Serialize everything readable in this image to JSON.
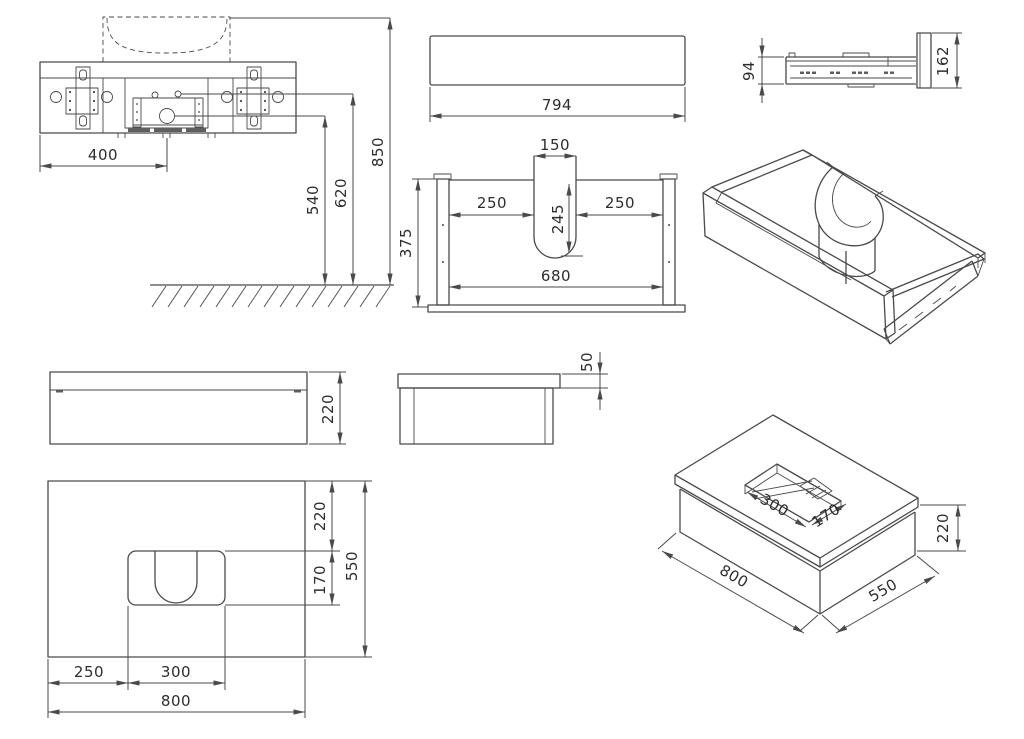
{
  "drawing": {
    "background": "#ffffff",
    "line_color": "#4a4a4a",
    "text_color": "#2d2d2d",
    "views": {
      "wall_mounting_front": {
        "dims": {
          "bracket_spacing": "400",
          "drain_height": "540",
          "supply_height": "620",
          "overall_height": "850"
        }
      },
      "drawer_front_panel": {
        "dims": {
          "width": "794"
        }
      },
      "drawer_slide_side": {
        "dims": {
          "slide_height": "94",
          "front_height": "162"
        }
      },
      "drawer_box_front": {
        "dims": {
          "cutout_width": "150",
          "left_clearance": "250",
          "right_clearance": "250",
          "cutout_depth": "245",
          "inner_width": "680",
          "box_height": "375"
        }
      },
      "cabinet_front": {
        "dims": {
          "height": "220"
        }
      },
      "cabinet_side": {
        "dims": {
          "countertop_thickness": "50"
        }
      },
      "countertop_plan": {
        "dims": {
          "back_offset": "220",
          "cutout_depth": "170",
          "total_depth": "550",
          "left_offset": "250",
          "cutout_width": "300",
          "total_width": "800"
        }
      },
      "cabinet_3d": {
        "dims": {
          "cutout_width": "300",
          "cutout_depth": "170",
          "body_height": "220",
          "width": "800",
          "depth": "550"
        }
      }
    }
  }
}
